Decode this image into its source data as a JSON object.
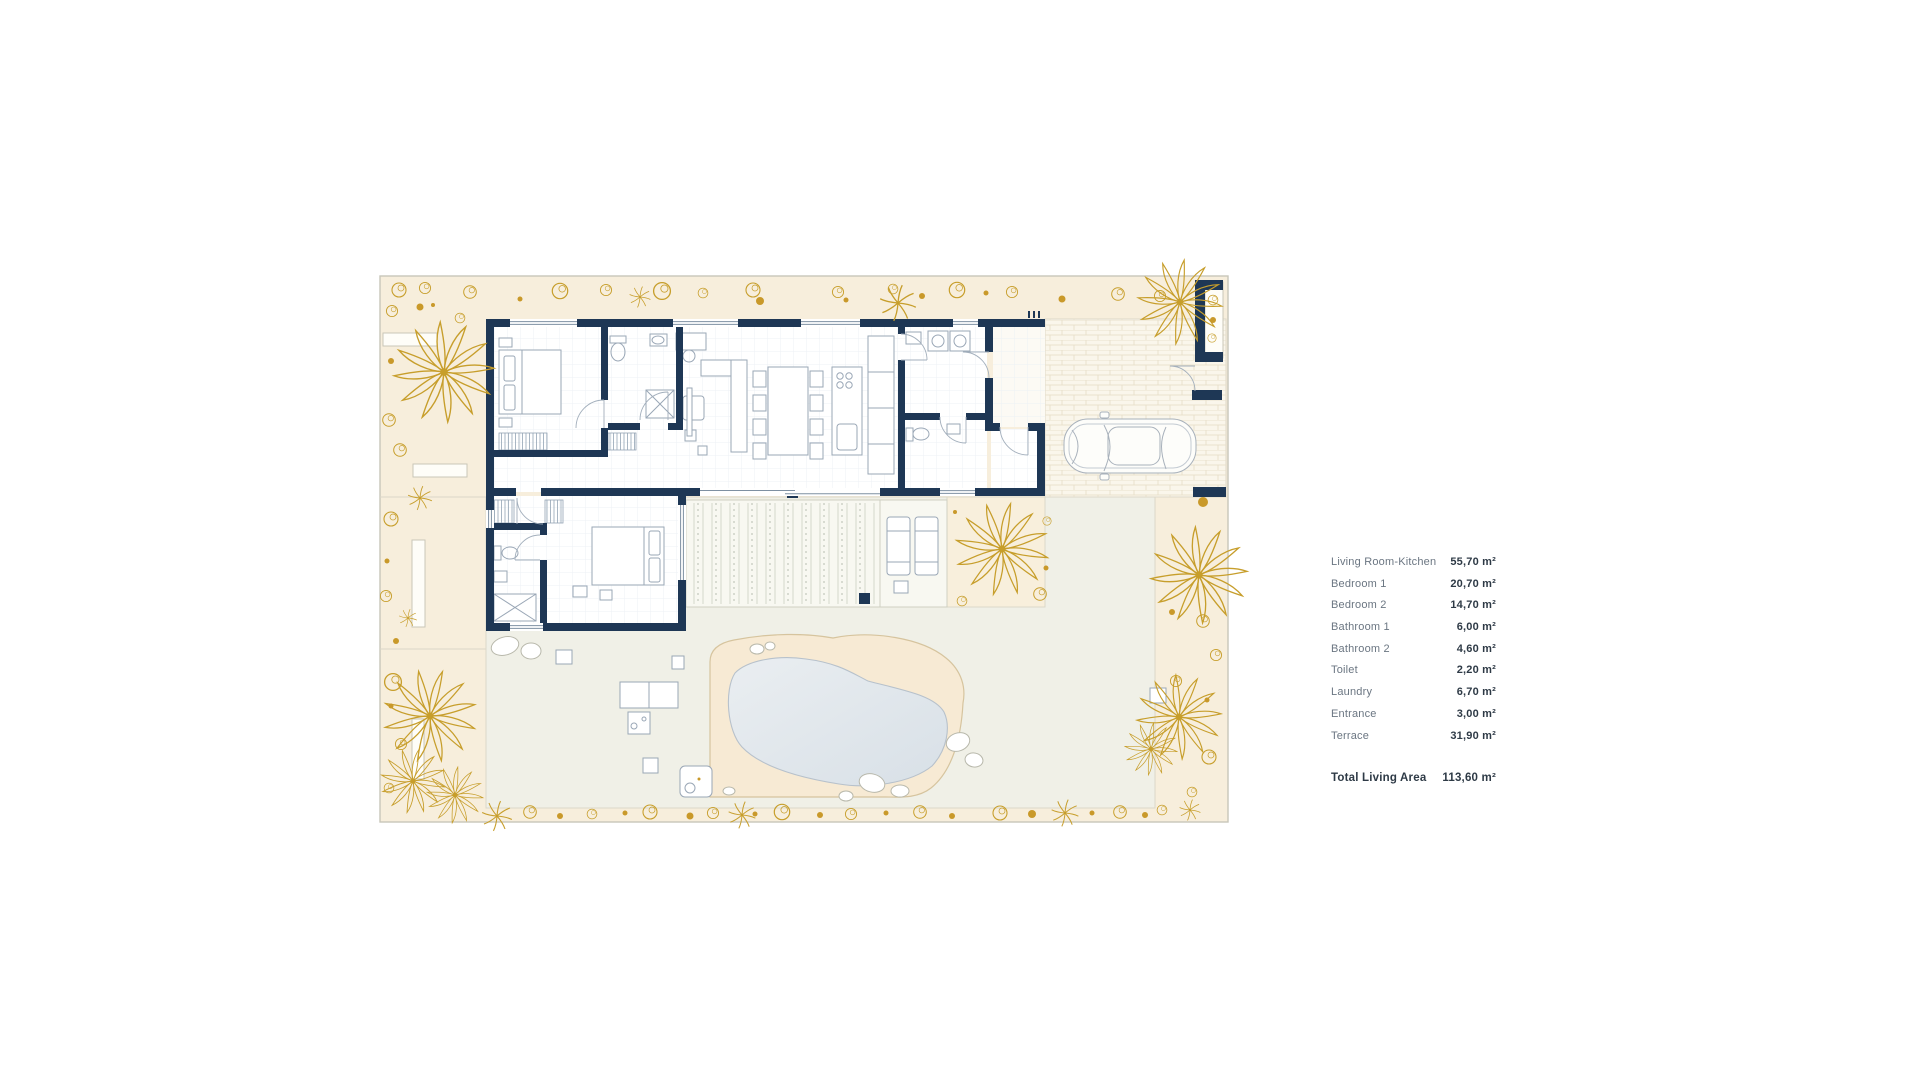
{
  "page": {
    "background": "#ffffff",
    "type": "architectural floor plan with area schedule"
  },
  "legend": {
    "rows": [
      {
        "label": "Living Room-Kitchen",
        "value": "55,70 m²"
      },
      {
        "label": "Bedroom 1",
        "value": "20,70 m²"
      },
      {
        "label": "Bedroom 2",
        "value": "14,70 m²"
      },
      {
        "label": "Bathroom 1",
        "value": "6,00 m²"
      },
      {
        "label": "Bathroom 2",
        "value": "4,60 m²"
      },
      {
        "label": "Toilet",
        "value": "2,20 m²"
      },
      {
        "label": "Laundry",
        "value": "6,70 m²"
      },
      {
        "label": "Entrance",
        "value": "3,00 m²"
      },
      {
        "label": "Terrace",
        "value": "31,90 m²"
      }
    ],
    "total": {
      "label": "Total Living Area",
      "value": "113,60 m²"
    }
  },
  "colors": {
    "wall_navy": "#1e3755",
    "garden_cream": "#f7eedc",
    "courtyard_gray": "#f0f0e7",
    "pool_water": "#e2e8ee",
    "pool_deck": "#f7ead4",
    "plant_gold": "#c79e2b",
    "driveway": "#faf6eb",
    "legend_label": "#6b7682",
    "legend_value": "#2e3a46"
  }
}
